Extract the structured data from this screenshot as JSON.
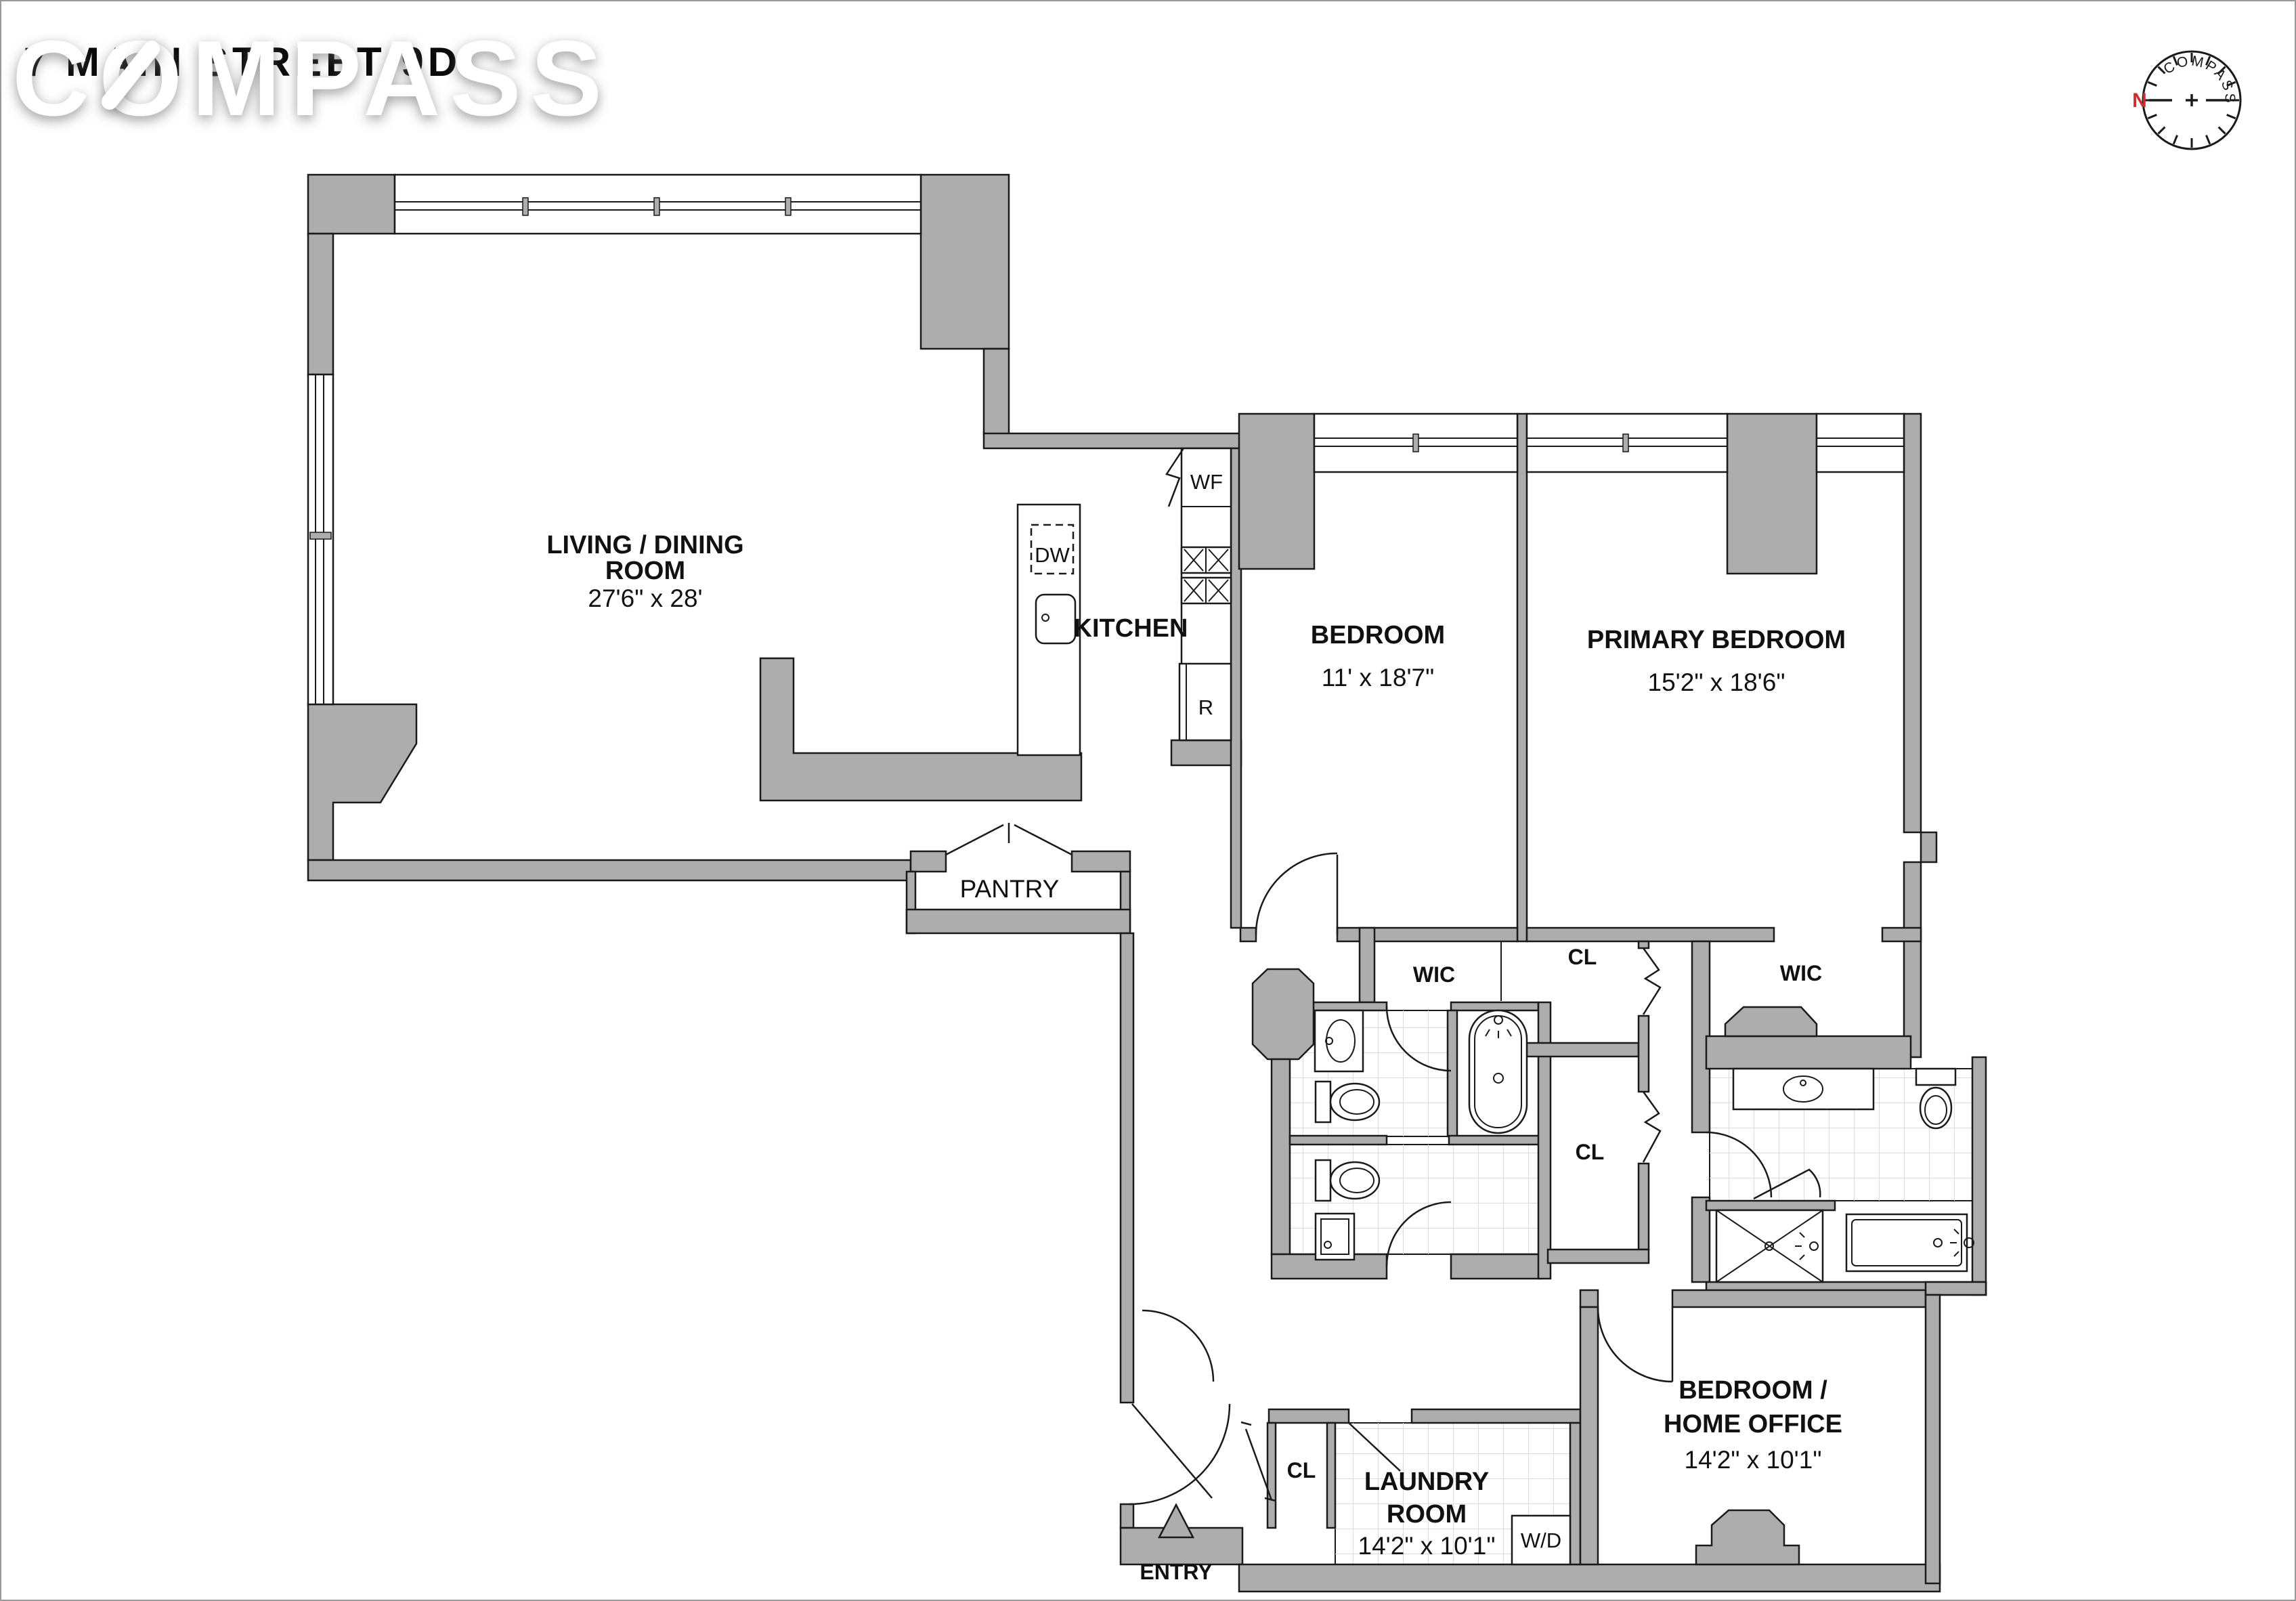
{
  "header": {
    "title": "7 MAIN STREET 9D",
    "watermark": "COMPASS"
  },
  "compass_rose": {
    "ring_label": "COMPASS",
    "north_label": "N",
    "north_color": "#c8312e"
  },
  "palette": {
    "wall_fill": "#adadad",
    "line": "#1a1a1a",
    "tile_line": "#dcdcdc",
    "background": "#ffffff"
  },
  "rooms": {
    "living_dining": {
      "line1": "LIVING / DINING",
      "line2": "ROOM",
      "dims": "27'6\" x 28'"
    },
    "kitchen": {
      "label": "KITCHEN"
    },
    "bedroom": {
      "name": "BEDROOM",
      "dims": "11' x 18'7\""
    },
    "primary_bedroom": {
      "name": "PRIMARY BEDROOM",
      "dims": "15'2\" x 18'6\""
    },
    "pantry": {
      "label": "PANTRY"
    },
    "wic_hall": {
      "label": "WIC"
    },
    "wic_primary": {
      "label": "WIC"
    },
    "cl_upper": {
      "label": "CL"
    },
    "cl_lower": {
      "label": "CL"
    },
    "cl_entry": {
      "label": "CL"
    },
    "bedroom_home_office": {
      "line1": "BEDROOM /",
      "line2": "HOME OFFICE",
      "dims": "14'2\" x 10'1\""
    },
    "laundry": {
      "line1": "LAUNDRY",
      "line2": "ROOM",
      "dims": "14'2\" x 10'1\""
    },
    "entry": {
      "label": "ENTRY"
    }
  },
  "appliances": {
    "dishwasher": "DW",
    "wine_fridge": "WF",
    "range": "R",
    "washer_dryer": "W/D"
  }
}
